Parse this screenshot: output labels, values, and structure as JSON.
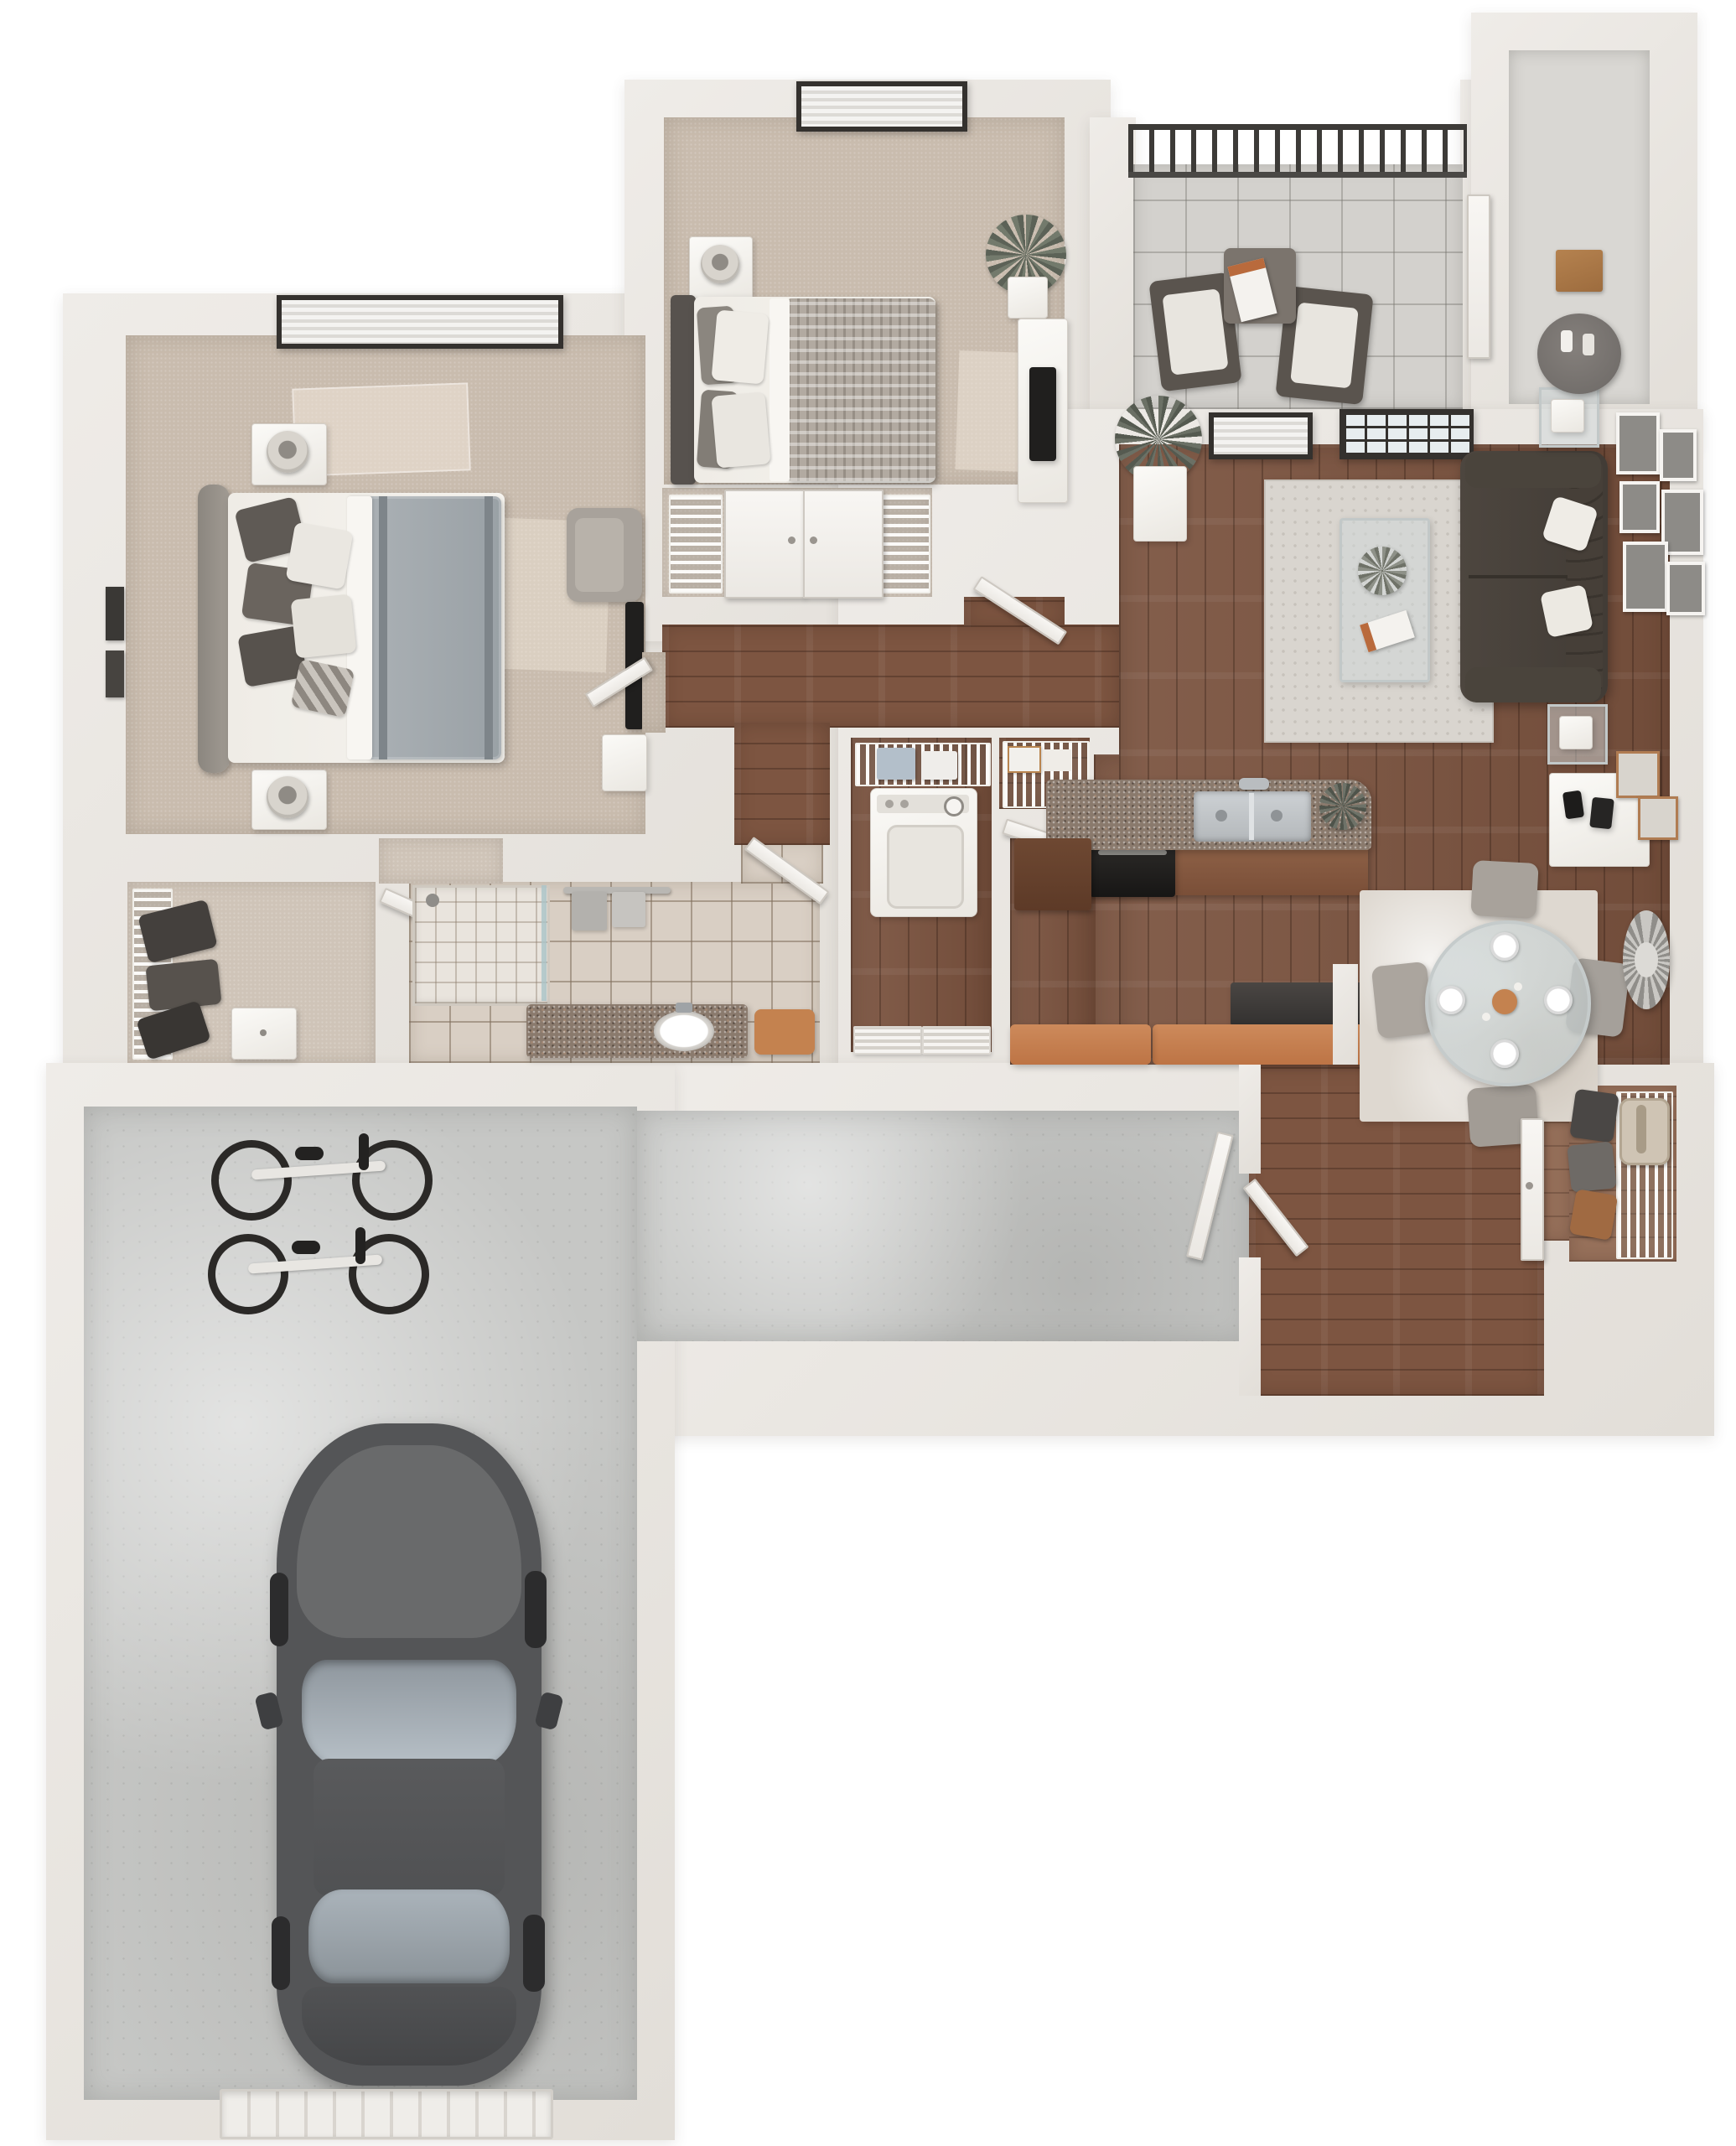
{
  "scene": {
    "kind": "3d-floor-plan-render",
    "view": "top-down dollhouse",
    "background": "#ffffff",
    "visible_text": "none",
    "unit_summary": "2-bedroom apartment with 1 bathroom, open living/dining/kitchen, balcony, storage closet, entry and attached single-car garage"
  },
  "palette": {
    "wall": "#e9e6e1",
    "carpet": "#c9bcae",
    "hardwood": "#7a523e",
    "concrete": "#c6c7c5",
    "bath_tile": "#d9cfc4",
    "balcony_stone": "#d3d1cd",
    "granite_counter": "#8a7a6d",
    "breakfast_bar": "#c07a4d",
    "sofa_leather": "#474038",
    "accent_orange": "#c4824f",
    "window_frame": "#34312e"
  },
  "rooms": [
    {
      "name": "master-bedroom",
      "floor": "carpet",
      "furniture": [
        "upholstered-bed",
        "headboard",
        "pillow-set",
        "gray-duvet",
        "nightstand-with-lamp",
        "nightstand-with-lamp",
        "armchair",
        "wall-tv",
        "media-shelf",
        "window-with-blinds",
        "wall-art",
        "sunlight-patches"
      ]
    },
    {
      "name": "master-closet",
      "floor": "carpet",
      "furniture": [
        "wire-shelving",
        "hanging-clothes",
        "dresser",
        "door"
      ]
    },
    {
      "name": "bathroom",
      "floor": "tile",
      "furniture": [
        "walk-in-shower",
        "granite-vanity",
        "oval-sink",
        "faucet",
        "towel-bar",
        "towels",
        "orange-bath-mat",
        "door"
      ]
    },
    {
      "name": "bedroom-2",
      "floor": "carpet",
      "furniture": [
        "bed",
        "patterned-duvet",
        "pillow-set",
        "nightstand-with-lamp",
        "potted-plant",
        "tv-console",
        "tv",
        "window-with-blinds",
        "door"
      ]
    },
    {
      "name": "bedroom-2-closet",
      "floor": "carpet",
      "furniture": [
        "double-doors",
        "wire-shelving",
        "wire-shelving"
      ]
    },
    {
      "name": "hallway",
      "floor": "hardwood",
      "furniture": [
        "palm-plant",
        "geometric-pedestal-decor"
      ]
    },
    {
      "name": "laundry-closet",
      "floor": "hardwood",
      "furniture": [
        "dryer",
        "wire-shelf",
        "folded-linens",
        "louvered-bifold-doors"
      ]
    },
    {
      "name": "pantry",
      "floor": "hardwood",
      "furniture": [
        "wire-shelves",
        "storage-boxes",
        "door"
      ]
    },
    {
      "name": "kitchen",
      "floor": "hardwood",
      "furniture": [
        "granite-counter",
        "stainless-double-sink",
        "faucet",
        "black-range",
        "brown-cabinets",
        "counter-plant",
        "breakfast-bar",
        "storage-bench",
        "half-wall"
      ]
    },
    {
      "name": "living-room",
      "floor": "hardwood",
      "furniture": [
        "tufted-leather-sofa",
        "white-throw-pillows",
        "glass-coffee-table",
        "coffee-table-plant",
        "magazine",
        "patterned-area-rug",
        "end-table-with-lamp",
        "end-table-with-lamp",
        "gallery-wall-frames",
        "copper-frames",
        "tv-console",
        "speakers",
        "french-door",
        "window-with-blinds"
      ]
    },
    {
      "name": "dining-area",
      "floor": "hardwood",
      "furniture": [
        "round-glass-table",
        "dining-chairs",
        "place-settings",
        "area-rug",
        "sunburst-mirror"
      ]
    },
    {
      "name": "entry",
      "floor": "hardwood",
      "furniture": [
        "closet-door",
        "corridor-door"
      ]
    },
    {
      "name": "coat-closet",
      "floor": "hardwood",
      "furniture": [
        "wire-rack",
        "hanging-clothes",
        "backpack"
      ]
    },
    {
      "name": "balcony",
      "floor": "stone-tile",
      "furniture": [
        "metal-railing",
        "patio-chair",
        "patio-chair",
        "side-table",
        "magazine"
      ]
    },
    {
      "name": "storage-closet",
      "floor": "gray",
      "furniture": [
        "cardboard-boxes",
        "round-table"
      ]
    },
    {
      "name": "garage-corridor",
      "floor": "concrete",
      "furniture": [
        "door-to-entry"
      ]
    },
    {
      "name": "garage",
      "floor": "concrete",
      "furniture": [
        "car",
        "bicycle",
        "bicycle",
        "garage-door"
      ]
    }
  ],
  "counts": {
    "bedrooms": 2,
    "bathrooms": 1,
    "balcony_chairs": 2,
    "dining_seats": 4,
    "place_settings": 4,
    "bicycles": 2,
    "cars": 1,
    "gallery_frames": 6
  }
}
